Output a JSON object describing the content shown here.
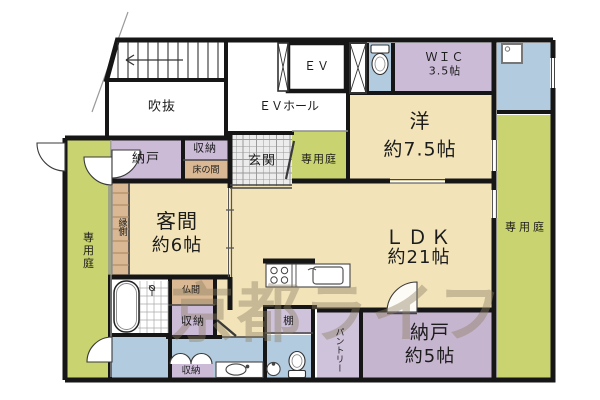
{
  "plan": {
    "title": "マンション間取り図",
    "watermark": "京都ライフ",
    "palette": {
      "room_cream": "#F2E4B8",
      "storage_purple": "#CBBBD7",
      "storage_purple_dark": "#C6B5CF",
      "storage_purple_light": "#CFC3DB",
      "wet_area_blue": "#B3CBDF",
      "garden_green": "#C9D36F",
      "wood_tan": "#D9B893",
      "wall_black": "#161616"
    },
    "rooms": {
      "void": "吹抜",
      "ev_hall": "ＥＶホール",
      "elevator": "ＥＶ",
      "wic": {
        "name": "ＷＩＣ",
        "area": "3.5帖"
      },
      "western": {
        "name": "洋",
        "area": "約7.5帖"
      },
      "garden_top": "専用庭",
      "garden_right": "専用庭",
      "garden_left": "専用庭",
      "storage_nw": "納戸",
      "closet_n": "収納",
      "entrance": "玄関",
      "tokonoma": "床の間",
      "engawa": "縁側",
      "guest": {
        "name": "客間",
        "area": "約6帖"
      },
      "ldk": {
        "name": "ＬＤＫ",
        "area": "約21帖"
      },
      "butsuma": "仏間",
      "closet_mid": "収納",
      "shelf": "棚",
      "pantry": "パントリー",
      "storage_se": {
        "name": "納戸",
        "area": "約5帖"
      },
      "closet_s": "収納"
    },
    "fixtures": [
      "staircase",
      "elevator-cab",
      "pipe-shaft",
      "toilet-north",
      "utility-sink",
      "kitchen-counter",
      "bathtub",
      "shower",
      "washbasin-counter",
      "round-basin",
      "toilet-south"
    ]
  }
}
